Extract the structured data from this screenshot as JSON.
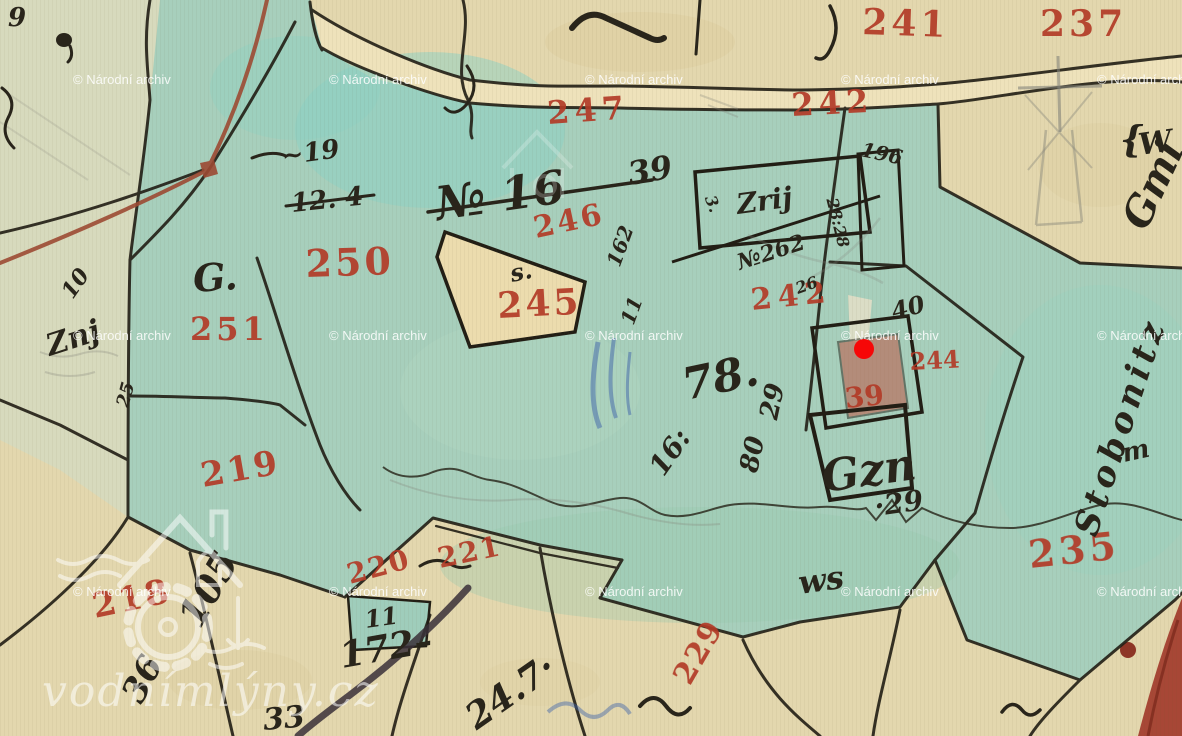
{
  "map": {
    "watermark": {
      "archive_notice": "© Národní archiv",
      "site": "vodnímlýny.cz"
    },
    "colors": {
      "red_label": "#b23a27",
      "ink": "#29251b",
      "watermark": "#ffffff",
      "marker": "#f60707",
      "green": "#a7cfbc",
      "paper": "#e3d7ae",
      "road_red": "#9c4a33",
      "deep_red_road": "#a23b2b",
      "blue_pencil": "#3f63aa"
    },
    "red_labels": [
      {
        "text": "241"
      },
      {
        "text": "237"
      },
      {
        "text": "247"
      },
      {
        "text": "242"
      },
      {
        "text": "250"
      },
      {
        "text": "251"
      },
      {
        "text": "245"
      },
      {
        "text": "246"
      },
      {
        "text": "242"
      },
      {
        "text": "244"
      },
      {
        "text": "39"
      },
      {
        "text": "219"
      },
      {
        "text": "218"
      },
      {
        "text": "220"
      },
      {
        "text": "221"
      },
      {
        "text": "229"
      },
      {
        "text": "235"
      }
    ],
    "ink_labels": [
      {
        "text": "9"
      },
      {
        "text": "~19"
      },
      {
        "text": "12. 4"
      },
      {
        "text": "№ 16"
      },
      {
        "text": "39"
      },
      {
        "text": "162"
      },
      {
        "text": "G."
      },
      {
        "text": "Znj"
      },
      {
        "text": "10"
      },
      {
        "text": "25"
      },
      {
        "text": "s."
      },
      {
        "text": "11"
      },
      {
        "text": "Zrij"
      },
      {
        "text": "3."
      },
      {
        "text": "№262"
      },
      {
        "text": "28:28"
      },
      {
        "text": "196"
      },
      {
        "text": "40"
      },
      {
        "text": "26"
      },
      {
        "text": "78."
      },
      {
        "text": "16:"
      },
      {
        "text": "80"
      },
      {
        "text": "29"
      },
      {
        "text": "Gzn"
      },
      {
        "text": "·29"
      },
      {
        "text": "ws"
      },
      {
        "text": "105"
      },
      {
        "text": "36"
      },
      {
        "text": "11"
      },
      {
        "text": "172–"
      },
      {
        "text": "33"
      },
      {
        "text": "24.7·"
      },
      {
        "text": "W"
      },
      {
        "text": "{"
      },
      {
        "text": "Gmi"
      },
      {
        "text": "Stobonitz"
      },
      {
        "text": "m"
      }
    ]
  }
}
